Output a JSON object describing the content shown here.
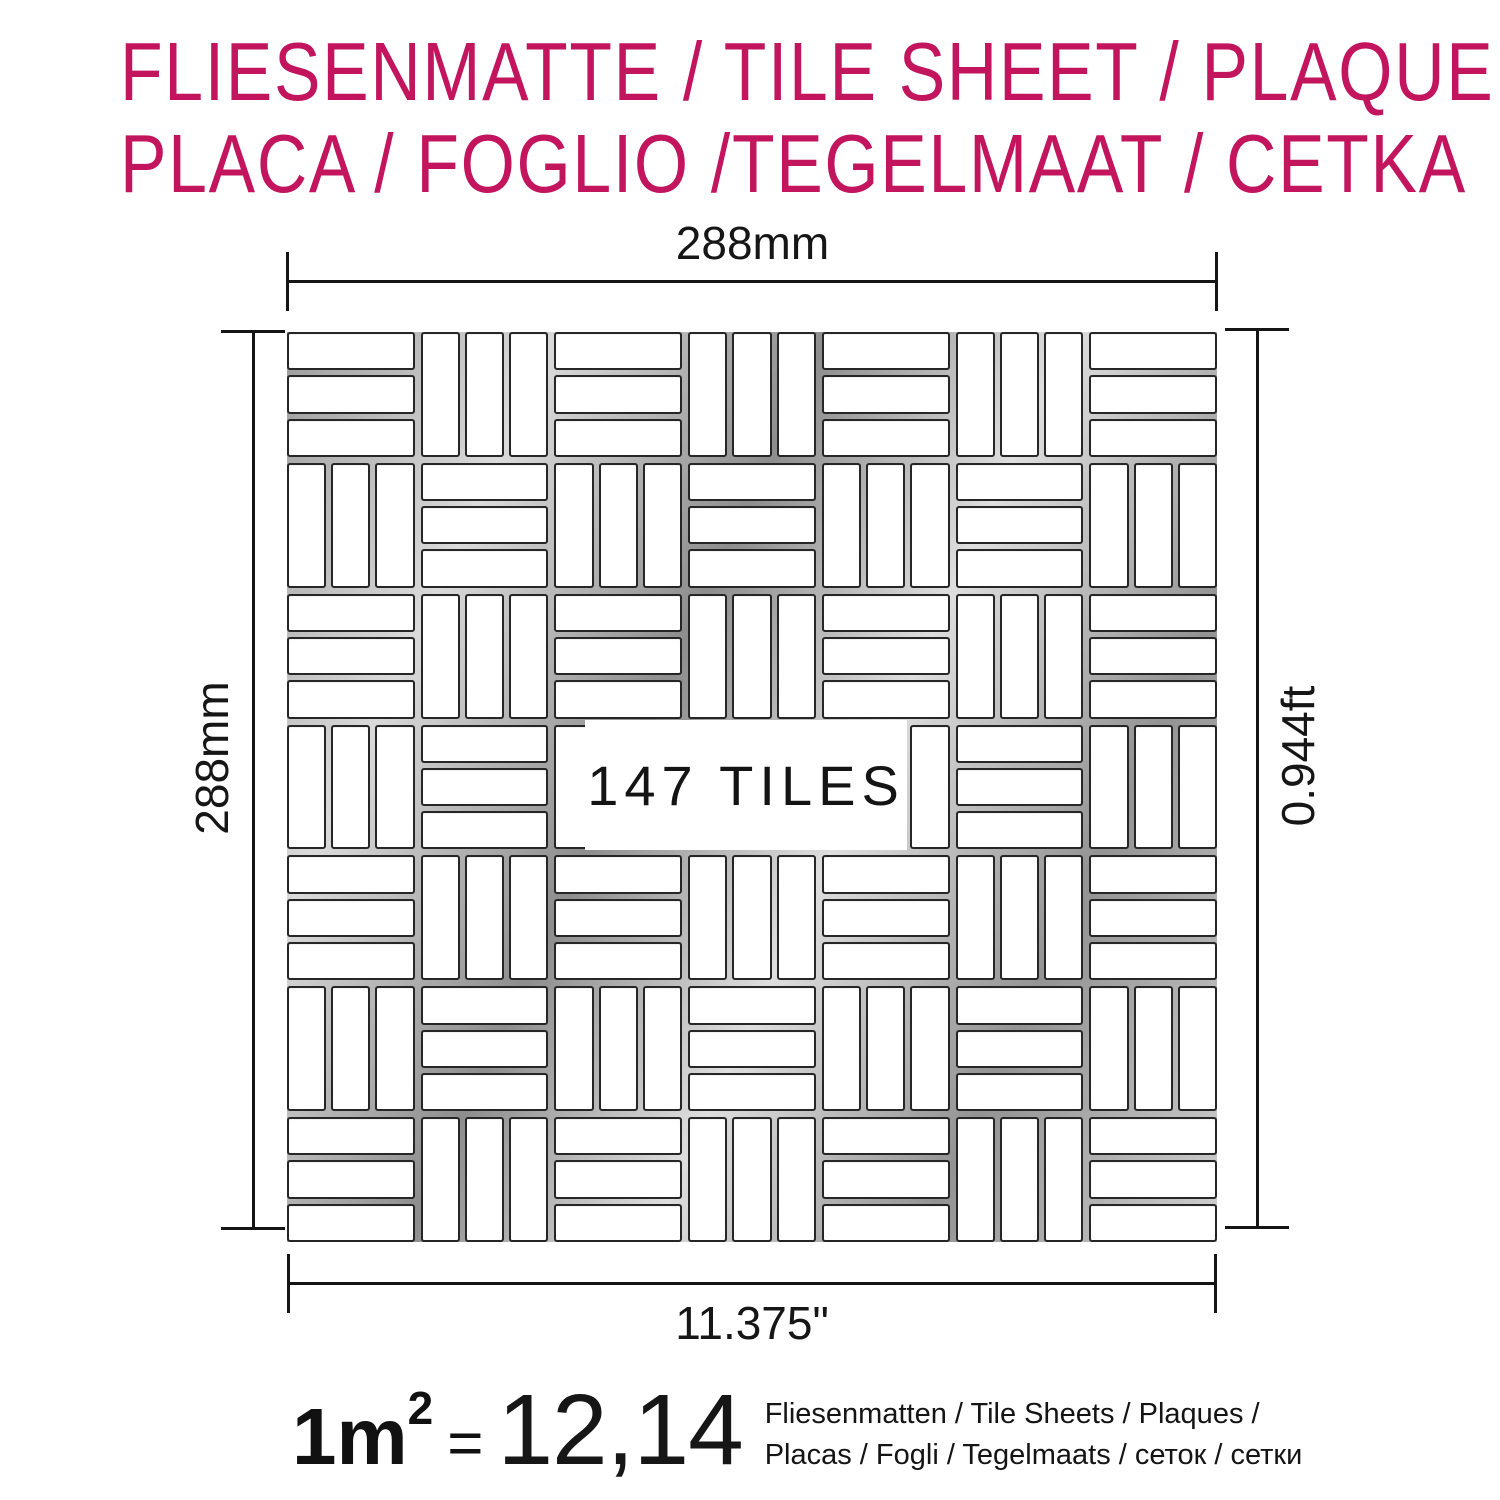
{
  "title": {
    "line1": "FLIESENMATTE / TILE SHEET / PLAQUE",
    "line2": "PLACA / FOGLIO /TEGELMAAT / CETKA",
    "color": "#C2155E"
  },
  "dimensions": {
    "top_label": "288mm",
    "left_label": "288mm",
    "right_label": "0.944ft",
    "bottom_label": "11.375\""
  },
  "sheet": {
    "tile_count_label": "147 TILES",
    "pattern": {
      "rows": 7,
      "cols": 7,
      "tiles_per_block": 3,
      "first_block": "horizontal",
      "alternation": "checkerboard"
    }
  },
  "conversion": {
    "quantity": "1m",
    "exponent": "2",
    "equals": "=",
    "value": "12,14",
    "unit_line1": "Fliesenmatten / Tile Sheets /  Plaques /",
    "unit_line2": "Placas / Fogli / Tegelmaats / сеток / сетки"
  }
}
